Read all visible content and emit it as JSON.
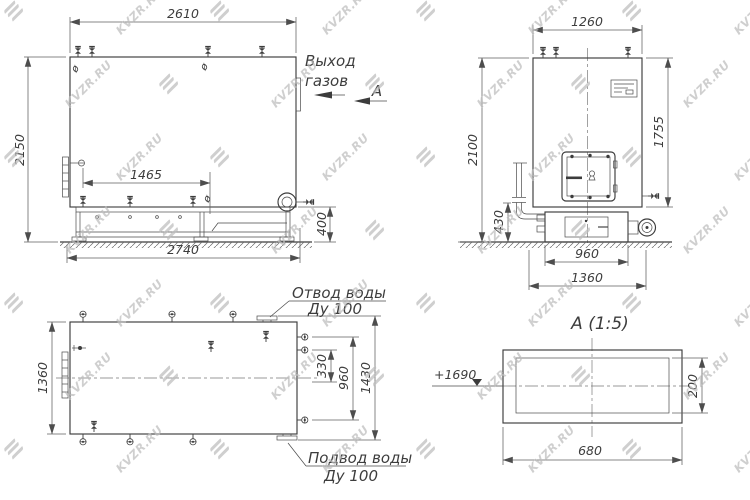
{
  "watermark": {
    "text": "KVZR.RU"
  },
  "marks": {
    "diameter": "ø"
  },
  "side_view": {
    "dim_width_top": "2610",
    "dim_height_left": "2150",
    "dim_valve_span": "1465",
    "dim_width_bottom": "2740",
    "dim_frame_height": "400",
    "gas_outlet_line1": "Выход",
    "gas_outlet_line2": "газов",
    "section_arrow_label": "А"
  },
  "front_view": {
    "dim_width_top": "1260",
    "dim_height_left": "2100",
    "dim_height_right": "1755",
    "dim_pipe_height": "430",
    "dim_base_width": "960",
    "dim_overall_width": "1360"
  },
  "plan_view": {
    "dim_height_left": "1360",
    "dim_nozzle_inner": "330",
    "dim_nozzle_mid": "960",
    "dim_nozzle_outer": "1430",
    "outlet_label_line1": "Отвод воды",
    "outlet_label_line2": "Ду 100",
    "inlet_label_line1": "Подвод воды",
    "inlet_label_line2": "Ду 100"
  },
  "section_view": {
    "title": "А (1:5)",
    "level_mark": "+1690",
    "dim_width": "680",
    "dim_height": "200"
  }
}
